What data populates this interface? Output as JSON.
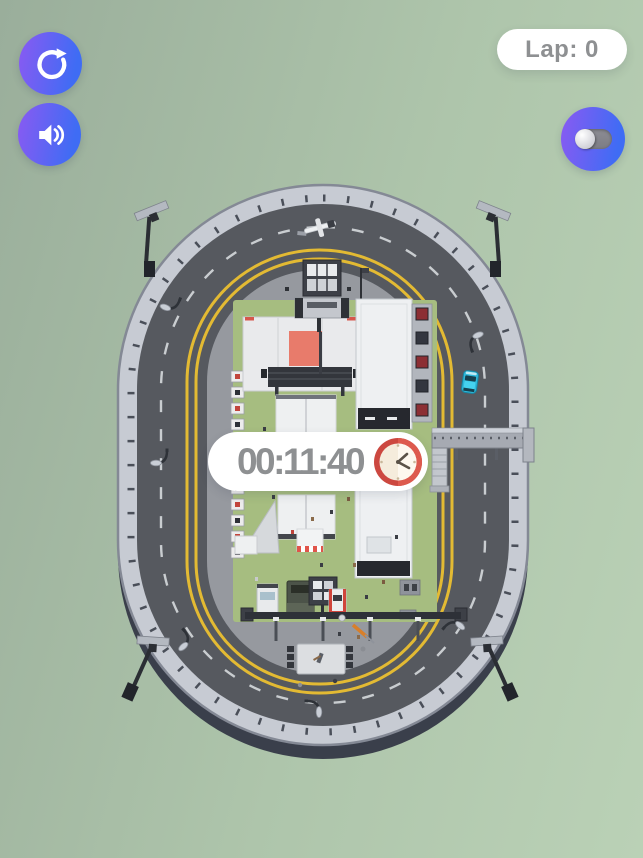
{
  "hud": {
    "lap": {
      "label": "Lap: 0"
    },
    "timer": {
      "value": "00:11:40",
      "icon": "clock"
    },
    "buttons": {
      "restart": {
        "icon": "restart-arrow"
      },
      "sound": {
        "icon": "speaker-on"
      },
      "mode_toggle": {
        "icon": "toggle-switch",
        "state": "off"
      }
    }
  },
  "scene": {
    "type": "oval-race-track",
    "player_car_color": "#2fb9da",
    "track_line_color": "#e3ba33",
    "infield_landmarks": [
      "stage-with-screen",
      "jumbotron",
      "tents",
      "toilet-row",
      "trucks",
      "footbridge",
      "floodlights",
      "sound-stage-platform"
    ]
  },
  "colors": {
    "background_start": "#9aae9b",
    "background_end": "#bad1b6",
    "button_gradient_start": "#8a5af2",
    "button_gradient_end": "#3f6cf4",
    "pill_background": "#ffffff",
    "pill_text": "#8e9092",
    "clock_red": "#cc4840",
    "grass": "#a6bd80",
    "asphalt": "#56595f"
  }
}
